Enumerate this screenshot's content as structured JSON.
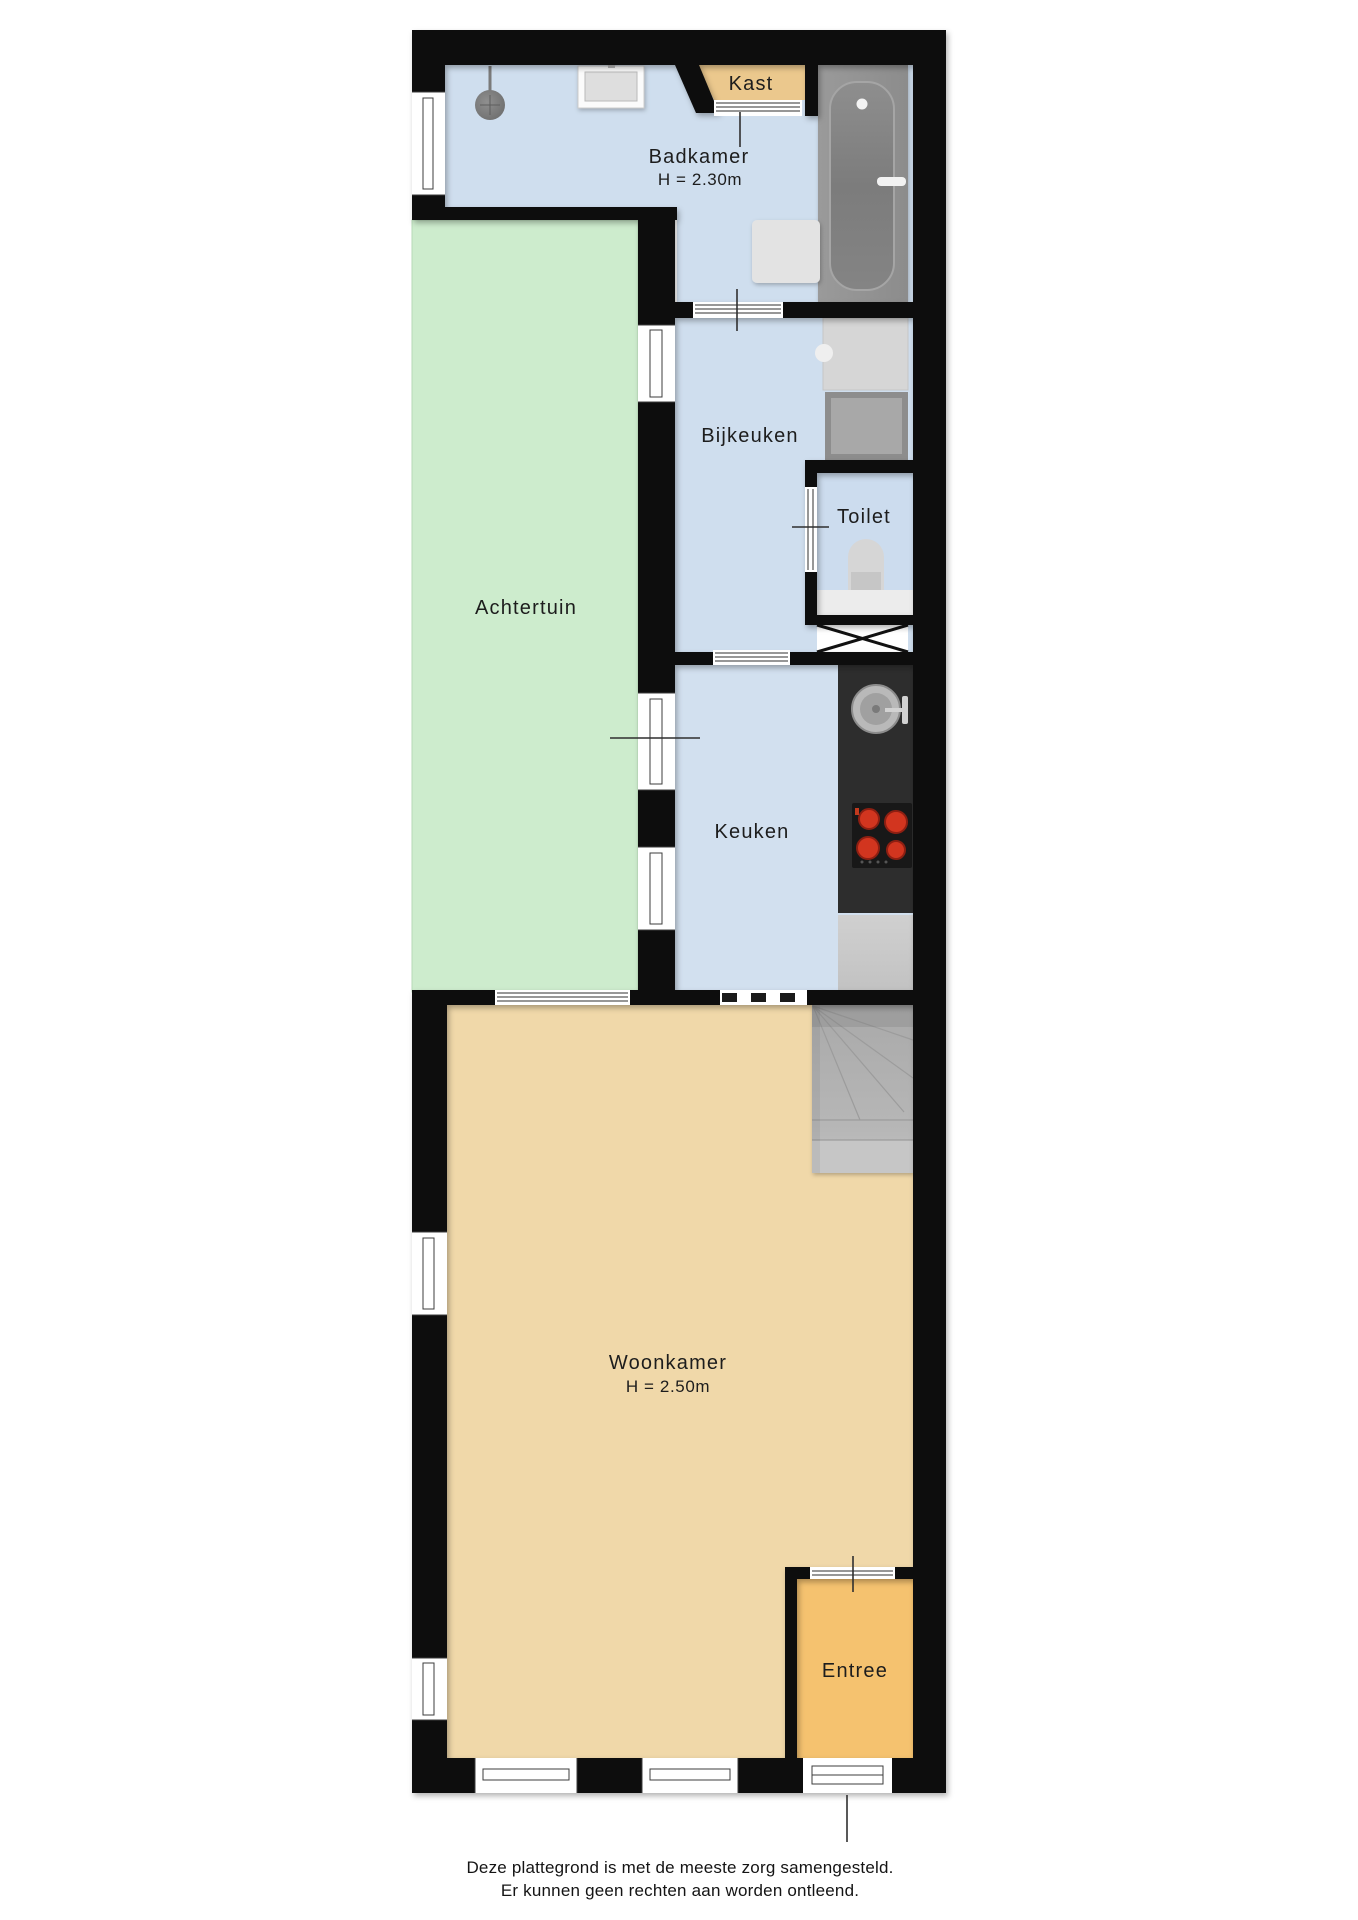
{
  "rooms": {
    "badkamer": {
      "label": "Badkamer",
      "height_note": "H = 2.30m"
    },
    "kast": {
      "label": "Kast"
    },
    "bijkeuken": {
      "label": "Bijkeuken"
    },
    "toilet": {
      "label": "Toilet"
    },
    "achtertuin": {
      "label": "Achtertuin"
    },
    "keuken": {
      "label": "Keuken"
    },
    "woonkamer": {
      "label": "Woonkamer",
      "height_note": "H = 2.50m"
    },
    "entree": {
      "label": "Entree"
    }
  },
  "footer": {
    "line1": "Deze plattegrond is met de meeste zorg samengesteld.",
    "line2": "Er kunnen geen rechten aan worden ontleend."
  },
  "colors": {
    "walls": "#0b0b0b",
    "wet_room_floor": "#cfdeee",
    "garden": "#cdeccd",
    "living_floor": "#f0d8a9",
    "entree_floor": "#f5c26f",
    "closet_floor": "#ebc88d",
    "stairs": "#b4b4b4",
    "kitchen_counter": "#2d2d2d",
    "cooktop_burner": "#d2351f"
  },
  "fixtures": [
    "bathtub",
    "shower-head",
    "bathroom-sink",
    "bath-mat",
    "closet-sliding-door",
    "laundry-appliance",
    "washing-machine",
    "toilet-bowl",
    "crawl-hatch",
    "kitchen-sink",
    "cooktop",
    "kitchen-cabinet",
    "staircase",
    "front-door",
    "garden-sliding-door"
  ]
}
